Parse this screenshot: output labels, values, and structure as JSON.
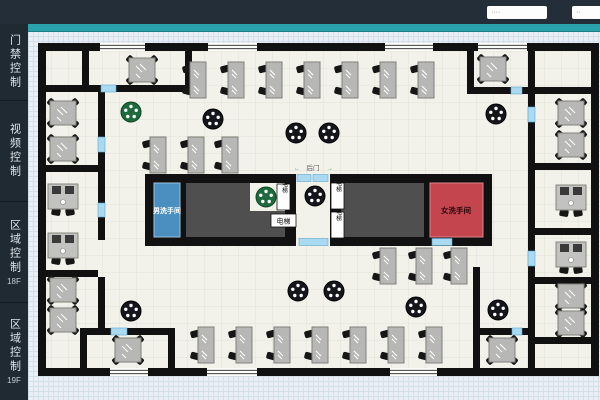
{
  "header": {
    "input1_placeholder": "····",
    "input2_placeholder": "··"
  },
  "sidebar": {
    "items": [
      {
        "label": "门禁控制",
        "sub": ""
      },
      {
        "label": "视频控制",
        "sub": ""
      },
      {
        "label": "区域控制",
        "sub": "18F"
      },
      {
        "label": "区域控制",
        "sub": "19F"
      }
    ]
  },
  "map": {
    "labels": {
      "mens_room": "男洗手间",
      "womens_room": "女洗手间",
      "elevator": "电梯",
      "back_door": "后门",
      "arrow_left": "←",
      "arrow_right": "→"
    },
    "colors": {
      "teal_bar": "#2aa2ab",
      "header_bg": "#232e38",
      "sidebar_bg": "#1f2a33",
      "mens_room_blue": "#4a8fc0",
      "womens_room_red": "#c4454e",
      "core_gray": "#4f4f4f",
      "door_marker_blue": "#a9daf2",
      "green_table": "#1d6b3c",
      "wall_black": "#111111"
    }
  }
}
